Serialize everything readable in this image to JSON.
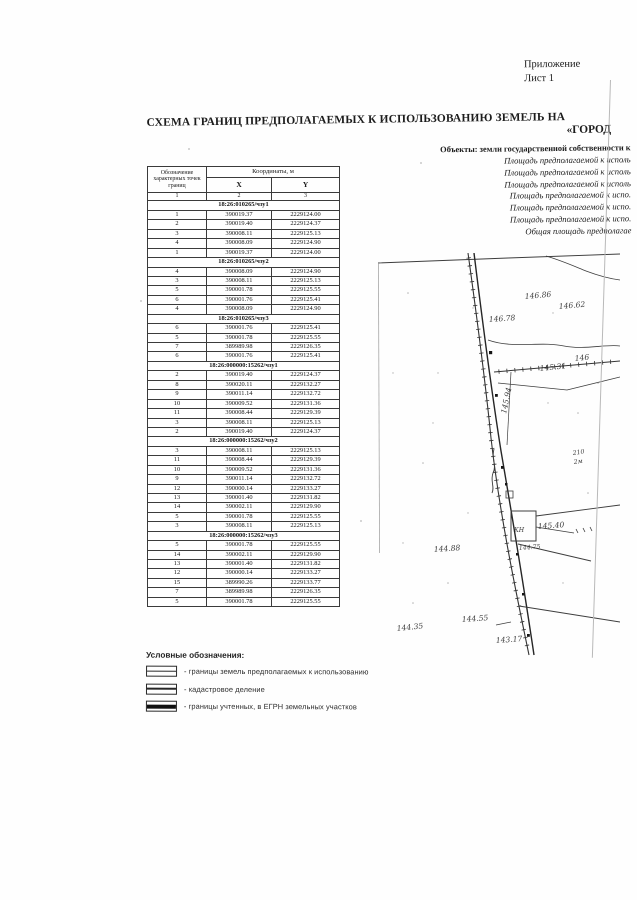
{
  "page": {
    "corner_note_line1": "Приложение",
    "corner_note_line2": "Лист 1",
    "title_line1": "СХЕМА ГРАНИЦ ПРЕДПОЛАГАЕМЫХ К ИСПОЛЬЗОВАНИЮ ЗЕМЕЛЬ  НА",
    "title_line2": "«ГОРОД",
    "objects_heading": "Объекты: земли государственной собственности к",
    "objects_lines": [
      "Площадь предполагаемой к исполь",
      "Площадь предполагаемой к исполь",
      "Площадь предполагаемой к исполь",
      "Площадь предполагаемой к испо.",
      "Площадь предполагаемой к испо.",
      "Площадь предполагаемой к испо.",
      "Общая площадь предполагае"
    ],
    "ink_color": "#1c1c1c",
    "line_color": "#3a3a3a"
  },
  "table": {
    "header": {
      "col1": "Обозначение характерных точек границ",
      "coords_group": "Координаты, м",
      "x": "X",
      "y": "Y",
      "n1": "1",
      "n2": "2",
      "n3": "3"
    },
    "sections": [
      {
        "title": "18:26:010265/чзу1",
        "rows": [
          [
            "1",
            "390019.37",
            "2229124.00"
          ],
          [
            "2",
            "390019.40",
            "2229124.37"
          ],
          [
            "3",
            "390008.11",
            "2229125.13"
          ],
          [
            "4",
            "390008.09",
            "2229124.90"
          ],
          [
            "1",
            "390019.37",
            "2229124.00"
          ]
        ]
      },
      {
        "title": "18:26:010265/чзу2",
        "rows": [
          [
            "4",
            "390008.09",
            "2229124.90"
          ],
          [
            "3",
            "390008.11",
            "2229125.13"
          ],
          [
            "5",
            "390001.78",
            "2229125.55"
          ],
          [
            "6",
            "390001.76",
            "2229125.41"
          ],
          [
            "4",
            "390008.09",
            "2229124.90"
          ]
        ]
      },
      {
        "title": "18:26:010265/чзу3",
        "rows": [
          [
            "6",
            "390001.76",
            "2229125.41"
          ],
          [
            "5",
            "390001.78",
            "2229125.55"
          ],
          [
            "7",
            "389989.98",
            "2229126.35"
          ],
          [
            "6",
            "390001.76",
            "2229125.41"
          ]
        ]
      },
      {
        "title": "18:26:000000:15262/чзу1",
        "rows": [
          [
            "2",
            "390019.40",
            "2229124.37"
          ],
          [
            "8",
            "390020.11",
            "2229132.27"
          ],
          [
            "9",
            "390011.14",
            "2229132.72"
          ],
          [
            "10",
            "390009.52",
            "2229131.36"
          ],
          [
            "11",
            "390008.44",
            "2229129.39"
          ],
          [
            "3",
            "390008.11",
            "2229125.13"
          ],
          [
            "2",
            "390019.40",
            "2229124.37"
          ]
        ]
      },
      {
        "title": "18:26:000000:15262/чзу2",
        "rows": [
          [
            "3",
            "390008.11",
            "2229125.13"
          ],
          [
            "11",
            "390008.44",
            "2229129.39"
          ],
          [
            "10",
            "390009.52",
            "2229131.36"
          ],
          [
            "9",
            "390011.14",
            "2229132.72"
          ],
          [
            "12",
            "390000.14",
            "2229133.27"
          ],
          [
            "13",
            "390001.40",
            "2229131.82"
          ],
          [
            "14",
            "390002.11",
            "2229129.90"
          ],
          [
            "5",
            "390001.78",
            "2229125.55"
          ],
          [
            "3",
            "390008.11",
            "2229125.13"
          ]
        ]
      },
      {
        "title": "18:26:000000:15262/чзу3",
        "rows": [
          [
            "5",
            "390001.78",
            "2229125.55"
          ],
          [
            "14",
            "390002.11",
            "2229129.90"
          ],
          [
            "13",
            "390001.40",
            "2229131.82"
          ],
          [
            "12",
            "390000.14",
            "2229133.27"
          ],
          [
            "15",
            "389990.26",
            "2229133.77"
          ],
          [
            "7",
            "389989.98",
            "2229126.35"
          ],
          [
            "5",
            "390001.78",
            "2229125.55"
          ]
        ]
      }
    ]
  },
  "legend": {
    "heading": "Условные обозначения:",
    "items": [
      {
        "symbol": "thin",
        "label": "- границы земель предполагаемых к использованию"
      },
      {
        "symbol": "mid",
        "label": "- кадастровое деление"
      },
      {
        "symbol": "thick",
        "label": "- границы учтенных, в ЕГРН земельных участков"
      }
    ]
  },
  "map": {
    "labels": [
      {
        "text": "146.86",
        "x": 147,
        "y": 46,
        "rot": -5,
        "size": "n"
      },
      {
        "text": "146.62",
        "x": 181,
        "y": 56,
        "rot": -5,
        "size": "n"
      },
      {
        "text": "146.78",
        "x": 111,
        "y": 69,
        "rot": -4,
        "size": "n"
      },
      {
        "text": "146",
        "x": 197,
        "y": 108,
        "rot": -6,
        "size": "n"
      },
      {
        "text": "145.31",
        "x": 162,
        "y": 118,
        "rot": -6,
        "size": "n"
      },
      {
        "text": "145.94",
        "x": 128,
        "y": 161,
        "rot": -78,
        "size": "n"
      },
      {
        "text": "210",
        "x": 195,
        "y": 202,
        "rot": -8,
        "size": "s"
      },
      {
        "text": "2м",
        "x": 196,
        "y": 211,
        "rot": -8,
        "size": "s"
      },
      {
        "text": "КН",
        "x": 136,
        "y": 279,
        "rot": 0,
        "size": "s"
      },
      {
        "text": "145.40",
        "x": 160,
        "y": 276,
        "rot": -4,
        "size": "n"
      },
      {
        "text": "144.75",
        "x": 141,
        "y": 297,
        "rot": -4,
        "size": "s"
      },
      {
        "text": "144.88",
        "x": 56,
        "y": 299,
        "rot": -4,
        "size": "n"
      },
      {
        "text": "144.55",
        "x": 84,
        "y": 369,
        "rot": -4,
        "size": "n"
      },
      {
        "text": "144.35",
        "x": 19,
        "y": 378,
        "rot": -6,
        "size": "n"
      },
      {
        "text": "143.17",
        "x": 118,
        "y": 390,
        "rot": -4,
        "size": "n"
      }
    ]
  }
}
